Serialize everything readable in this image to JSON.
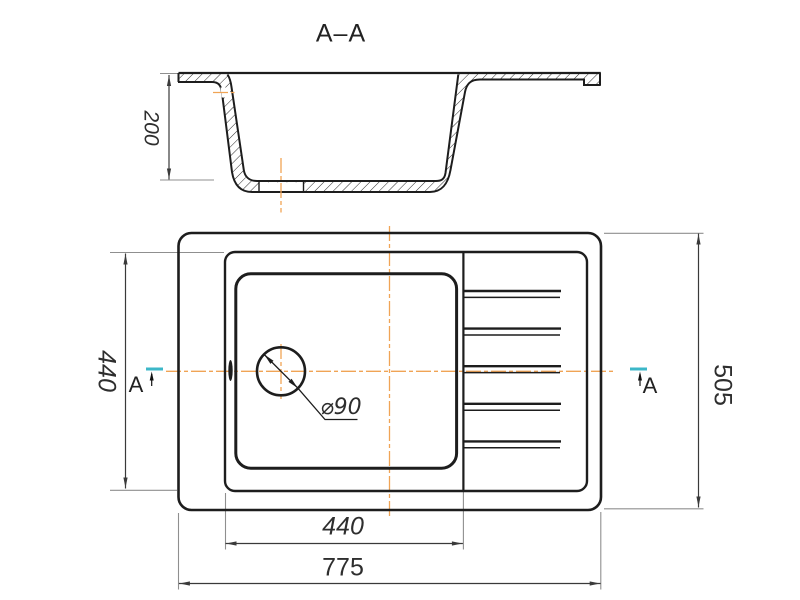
{
  "drawing": {
    "section_view": {
      "title": "A–A",
      "depth_dimension": "200"
    },
    "plan_view": {
      "bowl_height_dimension": "440",
      "bowl_width_dimension": "440",
      "overall_width_dimension": "775",
      "overall_depth_dimension": "505",
      "drain_diameter_label": "⌀90",
      "section_marker_left": "A",
      "section_marker_right": "A",
      "drainboard_ridge_pairs": 5
    },
    "colors": {
      "outline": "#1d1d1d",
      "dimension_line": "#3a3a3a",
      "extension_line": "#8f8f8f",
      "centerline_orange": "#f0a455",
      "section_marker_cyan": "#3cb7c8"
    }
  }
}
